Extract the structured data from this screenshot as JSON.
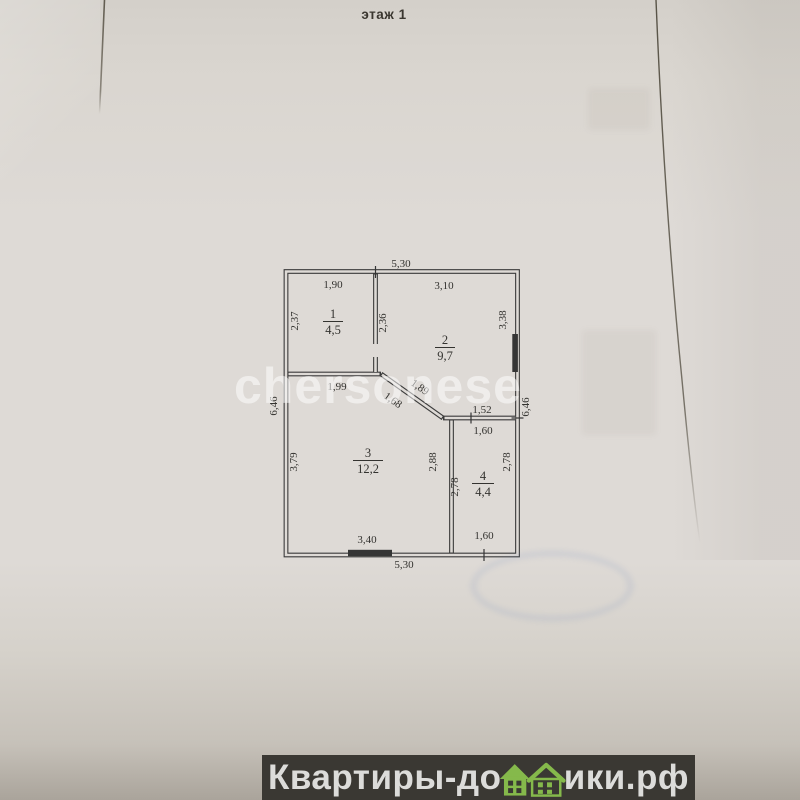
{
  "photo": {
    "title": "этаж 1"
  },
  "watermark": {
    "text": "chersonese"
  },
  "logo": {
    "text_left": "Квартиры-до",
    "text_right": "ики.рф",
    "green": "#85b94b",
    "bar_color": "#3a3833"
  },
  "plan": {
    "rooms": [
      {
        "number": "1",
        "area": "4,5"
      },
      {
        "number": "2",
        "area": "9,7"
      },
      {
        "number": "3",
        "area": "12,2"
      },
      {
        "number": "4",
        "area": "4,4"
      }
    ],
    "dims": {
      "top_total": "5,30",
      "top_room1": "1,90",
      "top_room2": "3,10",
      "room1_left": "2,37",
      "room1_right": "2,36",
      "room2_right": "3,38",
      "left_total": "6,46",
      "right_total": "6,46",
      "room3_top": "1,99",
      "diag_upper": "1,89",
      "diag_lower": "1,68",
      "room2_bottom": "1,52",
      "room4_top": "1,60",
      "room3_left": "3,79",
      "room3_right": "2,88",
      "room4_left": "2,78",
      "room4_right": "2,78",
      "bottom_room3": "3,40",
      "bottom_room4": "1,60",
      "bottom_total": "5,30"
    }
  }
}
